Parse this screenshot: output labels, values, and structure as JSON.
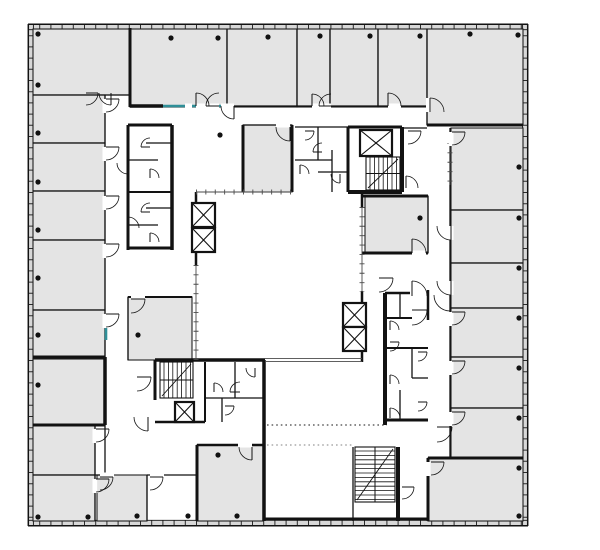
{
  "plan": {
    "canvas": {
      "w": 600,
      "h": 550
    },
    "palette": {
      "background": "#ffffff",
      "room_fill": "#e4e4e4",
      "room_stroke": "#1f1f1f",
      "wall": "#121212",
      "band_fill": "#d8d8d8",
      "band_tick": "#2b2b2b",
      "glazing": "#4a4a4a",
      "teal": "#2f8f98",
      "dot": "#111111",
      "dotted_dark": "#444444",
      "dotted_light": "#9a9a9a"
    },
    "band_fills": [
      [
        28,
        26.9,
        528,
        26.9
      ],
      [
        30.8,
        24,
        30.8,
        526
      ],
      [
        525.2,
        24,
        525.2,
        526
      ],
      [
        28,
        523,
        528,
        523
      ]
    ],
    "band_ticks": [
      [
        28,
        26.9,
        528,
        26.9
      ],
      [
        30.8,
        24,
        30.8,
        526
      ],
      [
        525.2,
        24,
        525.2,
        526
      ],
      [
        28,
        523,
        528,
        523
      ]
    ],
    "band_edges_outer": [
      [
        28,
        24.3,
        528,
        24.3
      ],
      [
        28.3,
        24,
        28.3,
        526
      ],
      [
        527.7,
        24,
        527.7,
        526
      ],
      [
        28,
        525.7,
        528,
        525.7
      ]
    ],
    "band_edges_inner": [
      [
        28,
        29.7,
        528,
        29.7
      ],
      [
        33.4,
        24,
        33.4,
        526
      ],
      [
        522.6,
        24,
        522.6,
        526
      ],
      [
        28,
        520.3,
        528,
        520.3
      ]
    ],
    "rooms": [
      [
        33,
        29,
        97,
        66
      ],
      [
        33,
        95,
        72,
        48
      ],
      [
        33,
        143,
        72,
        48
      ],
      [
        33,
        191,
        72,
        49
      ],
      [
        33,
        240,
        72,
        70
      ],
      [
        33,
        310,
        72,
        49
      ],
      [
        33,
        359,
        72,
        66
      ],
      [
        33,
        425,
        62,
        50
      ],
      [
        33,
        475,
        62,
        46
      ],
      [
        130,
        29,
        97,
        78
      ],
      [
        227,
        29,
        70,
        78
      ],
      [
        297,
        29,
        33,
        78
      ],
      [
        330,
        29,
        48,
        78
      ],
      [
        378,
        29,
        49,
        78
      ],
      [
        427,
        29,
        96,
        96
      ],
      [
        451,
        128,
        72,
        82
      ],
      [
        451,
        210,
        72,
        53
      ],
      [
        451,
        263,
        72,
        45
      ],
      [
        451,
        308,
        72,
        49
      ],
      [
        451,
        357,
        72,
        51
      ],
      [
        451,
        408,
        72,
        50
      ],
      [
        428,
        458,
        95,
        63
      ],
      [
        97,
        475,
        50,
        46
      ],
      [
        197,
        445,
        66,
        76
      ],
      [
        243,
        125,
        49,
        67
      ],
      [
        365,
        196,
        63,
        57
      ],
      [
        128,
        297,
        64,
        63
      ]
    ],
    "walls_thin": [
      [
        105,
        95,
        105,
        357
      ],
      [
        105,
        425,
        105,
        475
      ],
      [
        33,
        95,
        130,
        95
      ],
      [
        33,
        143,
        105,
        143
      ],
      [
        33,
        191,
        105,
        191
      ],
      [
        33,
        240,
        105,
        240
      ],
      [
        33,
        310,
        105,
        310
      ],
      [
        33,
        475,
        105,
        475
      ],
      [
        95,
        425,
        95,
        521
      ],
      [
        147,
        475,
        147,
        521
      ],
      [
        147,
        475,
        197,
        475
      ],
      [
        227,
        29,
        227,
        106
      ],
      [
        297,
        29,
        297,
        106
      ],
      [
        330,
        29,
        330,
        106
      ],
      [
        378,
        29,
        378,
        106
      ],
      [
        427,
        29,
        427,
        125
      ],
      [
        227,
        106,
        427,
        106
      ],
      [
        450,
        128,
        450,
        458
      ],
      [
        451,
        210,
        523,
        210
      ],
      [
        451,
        263,
        523,
        263
      ],
      [
        451,
        308,
        523,
        308
      ],
      [
        451,
        357,
        523,
        357
      ],
      [
        451,
        408,
        523,
        408
      ],
      [
        402,
        128,
        427,
        128
      ],
      [
        243,
        125,
        292,
        125
      ],
      [
        428,
        196,
        428,
        253
      ],
      [
        128,
        297,
        128,
        360
      ],
      [
        128,
        297,
        192,
        297,
        2
      ],
      [
        295,
        127,
        348,
        127
      ],
      [
        318,
        127,
        318,
        160
      ],
      [
        295,
        160,
        332,
        160
      ],
      [
        332,
        150,
        332,
        192
      ],
      [
        318,
        172,
        348,
        172
      ],
      [
        128,
        160,
        158,
        160
      ],
      [
        146,
        143,
        172,
        143
      ],
      [
        128,
        192,
        172,
        192,
        2
      ],
      [
        146,
        208,
        172,
        208
      ],
      [
        128,
        225,
        158,
        225
      ],
      [
        205,
        362,
        205,
        422,
        2
      ],
      [
        235,
        362,
        235,
        398
      ],
      [
        205,
        398,
        263,
        398
      ],
      [
        222,
        398,
        222,
        422
      ],
      [
        400,
        293,
        400,
        318
      ],
      [
        385,
        318,
        412,
        318,
        2
      ],
      [
        385,
        348,
        428,
        348,
        2
      ],
      [
        412,
        348,
        412,
        378
      ],
      [
        412,
        378,
        428,
        378
      ],
      [
        400,
        390,
        400,
        420
      ],
      [
        353,
        447,
        353,
        521
      ]
    ],
    "walls_thick": [
      [
        130,
        28,
        130,
        107
      ],
      [
        130,
        106,
        163,
        106,
        3.5
      ],
      [
        292,
        125,
        292,
        192
      ],
      [
        243,
        125,
        243,
        192
      ],
      [
        348,
        127,
        348,
        192
      ],
      [
        402,
        127,
        402,
        192,
        4
      ],
      [
        348,
        127,
        402,
        127
      ],
      [
        348,
        192,
        402,
        192,
        4
      ],
      [
        362,
        196,
        428,
        196
      ],
      [
        362,
        253,
        428,
        253
      ],
      [
        196,
        192,
        196,
        206,
        2.5
      ],
      [
        196,
        250,
        196,
        266,
        2.5
      ],
      [
        362,
        192,
        362,
        208,
        2.5
      ],
      [
        362,
        291,
        362,
        303,
        2.5
      ],
      [
        362,
        350,
        362,
        362,
        2.5
      ],
      [
        155,
        360,
        265,
        360,
        3.5
      ],
      [
        155,
        360,
        155,
        400
      ],
      [
        264,
        360,
        264,
        521,
        3.5
      ],
      [
        155,
        422,
        205,
        422,
        2.5
      ],
      [
        105,
        357,
        105,
        425,
        3.5
      ],
      [
        33,
        357,
        105,
        357
      ],
      [
        33,
        425,
        105,
        425
      ],
      [
        197,
        445,
        197,
        521
      ],
      [
        197,
        445,
        263,
        445,
        2.5
      ],
      [
        398,
        447,
        398,
        521,
        4
      ],
      [
        263,
        519,
        428,
        519
      ],
      [
        428,
        458,
        428,
        521
      ],
      [
        428,
        458,
        523,
        458
      ],
      [
        427,
        125,
        523,
        125
      ],
      [
        385,
        293,
        385,
        425,
        4
      ],
      [
        385,
        420,
        428,
        420
      ],
      [
        428,
        290,
        428,
        320,
        2.5
      ],
      [
        385,
        293,
        410,
        293,
        2.5
      ],
      [
        128,
        125,
        128,
        250
      ],
      [
        172,
        125,
        172,
        250,
        3.5
      ],
      [
        128,
        125,
        172,
        125
      ],
      [
        128,
        248,
        172,
        248
      ]
    ],
    "glazing": [
      [
        196,
        192,
        292,
        192
      ],
      [
        196,
        265,
        196,
        360
      ],
      [
        362,
        207,
        362,
        292
      ],
      [
        450,
        143,
        450,
        185
      ]
    ],
    "atrium_lines": [
      [
        265,
        358.6,
        362,
        358.6
      ],
      [
        265,
        361.4,
        362,
        361.4
      ]
    ],
    "teal_segments": [
      [
        163,
        106,
        185,
        106
      ],
      [
        192,
        106,
        227,
        106
      ],
      [
        106,
        316,
        106,
        340
      ]
    ],
    "openings": [
      [
        102.5,
        99,
        5,
        14
      ],
      [
        102.5,
        147,
        5,
        14
      ],
      [
        102.5,
        196,
        5,
        14
      ],
      [
        102.5,
        244,
        5,
        14
      ],
      [
        102.5,
        314,
        5,
        14
      ],
      [
        92.5,
        429,
        5,
        14
      ],
      [
        92.5,
        479,
        5,
        14
      ],
      [
        196,
        103.5,
        13,
        5
      ],
      [
        206,
        103.5,
        13,
        5
      ],
      [
        221,
        103.5,
        13,
        5
      ],
      [
        312,
        103.5,
        19,
        5
      ],
      [
        388,
        103.5,
        13,
        5
      ],
      [
        426,
        98,
        5,
        14
      ],
      [
        185,
        103.5,
        7,
        5
      ],
      [
        448.5,
        132,
        5,
        14
      ],
      [
        448.5,
        226,
        5,
        14
      ],
      [
        448.5,
        281,
        5,
        14
      ],
      [
        448.5,
        312,
        5,
        14
      ],
      [
        448.5,
        361,
        5,
        14
      ],
      [
        448.5,
        412,
        5,
        14
      ],
      [
        425.5,
        462,
        5,
        14
      ],
      [
        100,
        472.5,
        14,
        5
      ],
      [
        150,
        472.5,
        14,
        5
      ],
      [
        238,
        442.5,
        14,
        5
      ],
      [
        276,
        122.5,
        14,
        5
      ],
      [
        412,
        250.5,
        14,
        5
      ],
      [
        131,
        294.5,
        14,
        5
      ]
    ],
    "elevators": [
      [
        192,
        203,
        23,
        24
      ],
      [
        192,
        228,
        23,
        24
      ],
      [
        360,
        130,
        32,
        26
      ],
      [
        343,
        303,
        23,
        24
      ],
      [
        343,
        327,
        23,
        24
      ],
      [
        175,
        402,
        19,
        20
      ]
    ],
    "stairs": [
      [
        366,
        157,
        34,
        33,
        "h"
      ],
      [
        160,
        362,
        33,
        36,
        "h"
      ],
      [
        355,
        447,
        40,
        55,
        "v"
      ]
    ],
    "doors": [
      [
        106,
        99,
        13,
        0,
        90
      ],
      [
        106,
        147,
        13,
        0,
        90
      ],
      [
        106,
        196,
        13,
        0,
        90
      ],
      [
        106,
        244,
        13,
        0,
        90
      ],
      [
        106,
        314,
        13,
        0,
        90
      ],
      [
        96,
        429,
        13,
        0,
        90
      ],
      [
        96,
        479,
        13,
        0,
        90
      ],
      [
        86,
        93,
        12,
        0,
        90
      ],
      [
        111,
        93,
        12,
        90,
        180
      ],
      [
        196,
        106,
        13,
        270,
        360
      ],
      [
        219,
        106,
        13,
        180,
        270
      ],
      [
        234,
        106,
        13,
        90,
        180
      ],
      [
        312,
        106,
        12,
        270,
        360
      ],
      [
        331,
        106,
        12,
        180,
        270
      ],
      [
        388,
        106,
        13,
        270,
        360
      ],
      [
        430,
        112,
        14,
        270,
        360
      ],
      [
        452,
        132,
        13,
        0,
        90
      ],
      [
        451,
        226,
        14,
        90,
        180
      ],
      [
        451,
        281,
        14,
        90,
        180
      ],
      [
        452,
        312,
        13,
        0,
        90
      ],
      [
        452,
        361,
        13,
        0,
        90
      ],
      [
        452,
        412,
        13,
        0,
        90
      ],
      [
        431,
        462,
        13,
        0,
        90
      ],
      [
        100,
        477,
        13,
        0,
        90
      ],
      [
        150,
        477,
        13,
        0,
        90
      ],
      [
        252,
        447,
        13,
        90,
        180
      ],
      [
        290,
        127,
        14,
        90,
        180
      ],
      [
        412,
        253,
        14,
        270,
        360
      ],
      [
        131,
        299,
        14,
        0,
        90
      ],
      [
        150,
        147,
        9,
        180,
        270
      ],
      [
        150,
        178,
        9,
        270,
        360
      ],
      [
        150,
        212,
        9,
        180,
        270
      ],
      [
        150,
        242,
        9,
        270,
        360
      ],
      [
        128,
        163,
        11,
        90,
        180
      ],
      [
        128,
        228,
        11,
        270,
        360
      ],
      [
        305,
        131,
        9,
        0,
        90
      ],
      [
        322,
        152,
        9,
        180,
        270
      ],
      [
        340,
        174,
        9,
        90,
        180
      ],
      [
        300,
        174,
        9,
        270,
        360
      ],
      [
        408,
        131,
        13,
        0,
        90
      ],
      [
        406,
        188,
        12,
        270,
        360
      ],
      [
        379,
        278,
        14,
        0,
        90
      ],
      [
        450,
        295,
        16,
        90,
        180
      ],
      [
        412,
        296,
        15,
        270,
        360
      ],
      [
        412,
        310,
        15,
        0,
        90
      ],
      [
        390,
        330,
        9,
        270,
        360
      ],
      [
        390,
        342,
        9,
        0,
        90
      ],
      [
        418,
        352,
        9,
        0,
        90
      ],
      [
        390,
        384,
        9,
        270,
        360
      ],
      [
        418,
        402,
        9,
        0,
        90
      ],
      [
        390,
        418,
        10,
        270,
        360
      ],
      [
        137,
        377,
        14,
        0,
        90
      ],
      [
        148,
        417,
        14,
        90,
        180
      ],
      [
        214,
        392,
        9,
        270,
        360
      ],
      [
        240,
        392,
        10,
        180,
        270
      ],
      [
        255,
        368,
        9,
        90,
        180
      ],
      [
        225,
        406,
        9,
        0,
        90
      ],
      [
        437,
        427,
        15,
        0,
        90
      ],
      [
        402,
        487,
        12,
        0,
        90
      ]
    ],
    "dots": [
      [
        38,
        34
      ],
      [
        38,
        85
      ],
      [
        171,
        38
      ],
      [
        218,
        38
      ],
      [
        268,
        37
      ],
      [
        320,
        36
      ],
      [
        370,
        36
      ],
      [
        420,
        36
      ],
      [
        470,
        34
      ],
      [
        518,
        35
      ],
      [
        38,
        133
      ],
      [
        38,
        182
      ],
      [
        38,
        230
      ],
      [
        38,
        278
      ],
      [
        38,
        335
      ],
      [
        38,
        385
      ],
      [
        38,
        517
      ],
      [
        88,
        517
      ],
      [
        137,
        516
      ],
      [
        188,
        516
      ],
      [
        237,
        516
      ],
      [
        519,
        167
      ],
      [
        519,
        218
      ],
      [
        519,
        268
      ],
      [
        519,
        318
      ],
      [
        519,
        368
      ],
      [
        519,
        418
      ],
      [
        519,
        468
      ],
      [
        519,
        516
      ],
      [
        220,
        135
      ],
      [
        420,
        218
      ],
      [
        138,
        335
      ],
      [
        218,
        455
      ]
    ],
    "dotted_lines": [
      {
        "x1": 267,
        "y1": 425,
        "x2": 387,
        "y2": 425,
        "shade": "dark"
      },
      {
        "x1": 267,
        "y1": 445,
        "x2": 352,
        "y2": 445,
        "shade": "light"
      }
    ]
  }
}
